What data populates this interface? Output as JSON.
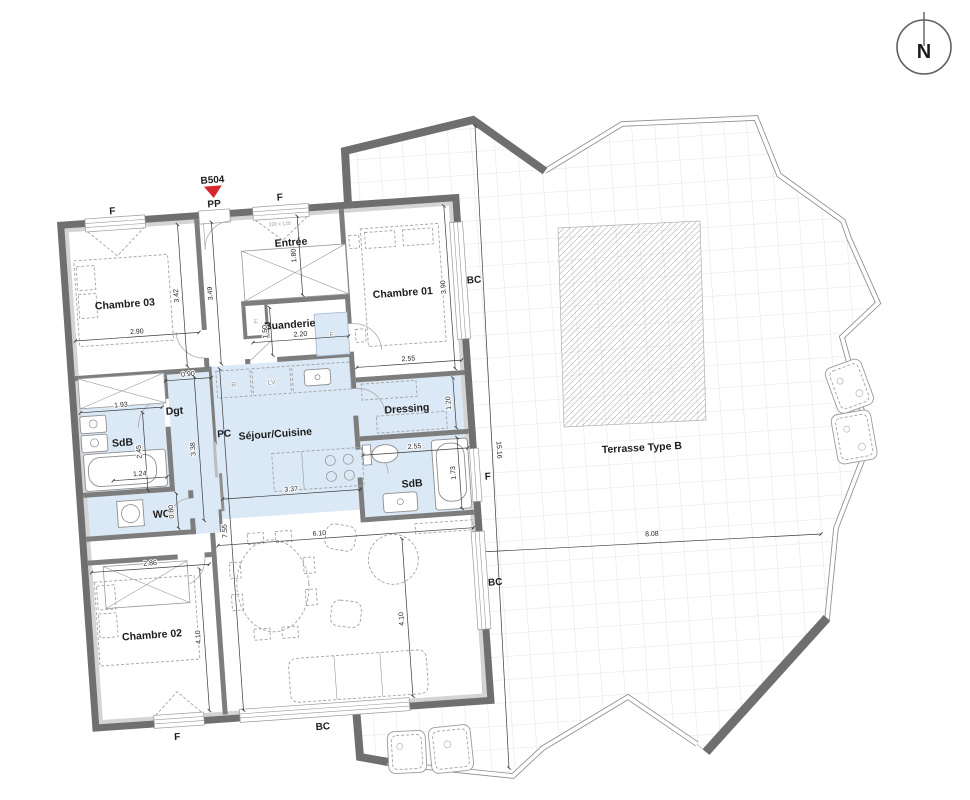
{
  "colors": {
    "accent_red": "#d7282f",
    "room_fill": "#dbe8f6",
    "wall_gray": "#6f6f6f"
  },
  "compass": {
    "north_label": "N"
  },
  "unit": {
    "code": "B504"
  },
  "rooms": {
    "chambre01": "Chambre 01",
    "chambre02": "Chambre 02",
    "chambre03": "Chambre 03",
    "entree": "Entrée",
    "buanderie": "Buanderie",
    "dressing": "Dressing",
    "sdb1": "SdB",
    "sdb2": "SdB",
    "wc": "WC",
    "dgt": "Dgt",
    "sejour": "Séjour/Cuisine",
    "terrasse": "Terrasse Type B"
  },
  "openings": {
    "f": "F",
    "pp": "PP",
    "bc": "BC",
    "pc": "PC"
  },
  "appliances": {
    "fridge": "R",
    "dishwasher": "LV",
    "washer": "F",
    "closet": "Pl"
  },
  "annotations": {
    "window_size": "220 x 120"
  },
  "dims": {
    "d290": "2.90",
    "d342": "3.42",
    "d349": "3.49",
    "d180": "1.80",
    "d150": "1.50",
    "d220": "2.20",
    "d255_ch01": "2.55",
    "d390": "3.90",
    "d120": "1.20",
    "d255_sdb": "2.55",
    "d173": "1.73",
    "d193": "1.93",
    "d090": "0.90",
    "d245": "2.45",
    "d338": "3.38",
    "d124": "1.24",
    "d080": "0.80",
    "d337": "3.37",
    "d755": "7.55",
    "d286": "2.86",
    "d410_ch02": "4.10",
    "d610": "6.10",
    "d410_sejour": "4.10",
    "d1516": "15.16",
    "d808": "8.08"
  }
}
